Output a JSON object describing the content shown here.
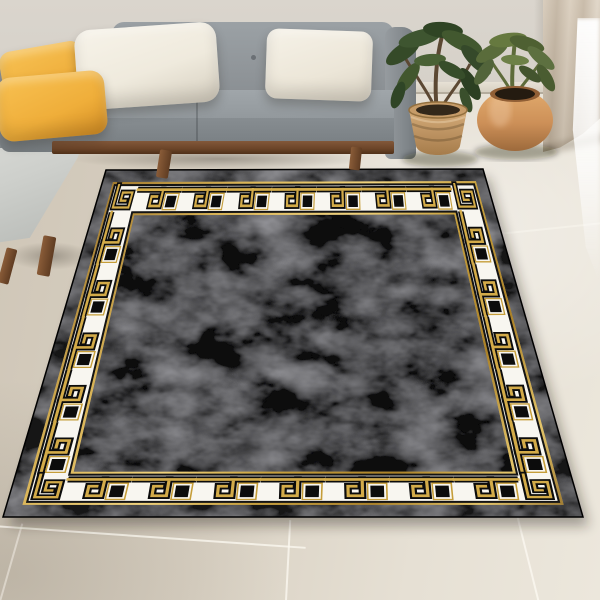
{
  "scene": {
    "description": "Product photograph of a rectangular black area rug with a gold and white Greek key (meander) border, shown in perspective on a beige tiled floor of a modern living room with a gray L-shaped sectional sofa, yellow and cream throw pillows, two potted plants and a beige curtain.",
    "objects": {
      "rug": "black rug with gold Greek key border",
      "sofa": "gray L-shaped sectional sofa with wooden legs",
      "pillows": [
        "yellow pillow",
        "yellow pillow",
        "cream pillow",
        "cream pillow"
      ],
      "planter_left": "woven basket planter with green plant",
      "planter_right": "round terracotta planter with green plant",
      "curtain": "beige curtain",
      "floor": "large beige glossy tiles",
      "wall": "light greige wall"
    }
  },
  "palette": {
    "wall": "#d6d1c9",
    "floor": "#d9d1c3",
    "curtain": "#d7cab8",
    "sofa": "#8d9296",
    "sofa_dark": "#757b7f",
    "chaise": "#cdcfcb",
    "wood": "#6b4428",
    "pillow_yellow": "#f0b13f",
    "pillow_cream": "#efeadd",
    "rug_black": "#141414",
    "rug_field_black": "#111111",
    "band_white": "#f8f6f0",
    "gold": "#c9a23f",
    "gold_light": "#f0d27c",
    "gold_dark": "#8a6420",
    "motif_black": "#0c0c0c",
    "leaf_dark": "#3a4f2b",
    "leaf_olive": "#5b6d3c",
    "basket": "#c59e6d",
    "terracotta": "#cd9058",
    "shadow": "rgba(30,24,14,0.35)"
  }
}
